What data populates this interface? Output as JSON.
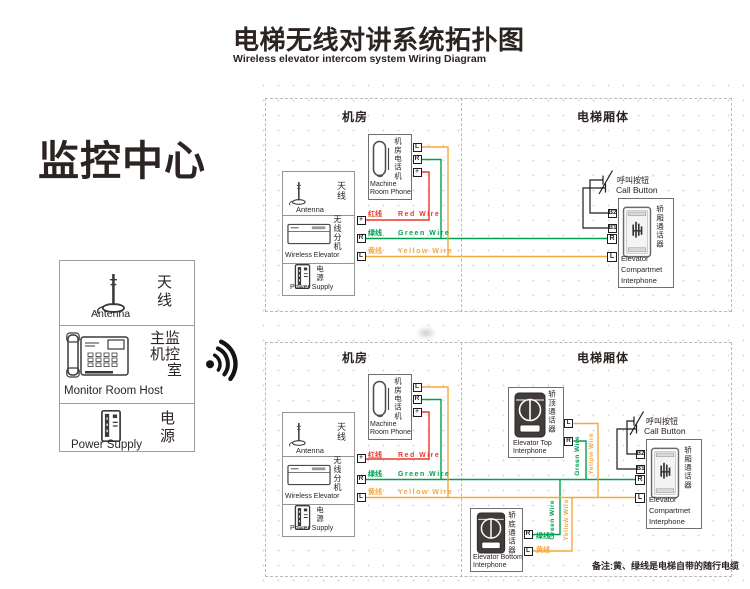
{
  "title": {
    "zh": "电梯无线对讲系统拓扑图",
    "en": "Wireless elevator intercom system Wiring Diagram"
  },
  "monitor": {
    "heading": "监控中心",
    "antenna_zh": "天线",
    "antenna_en": "Antenna",
    "host_line1": "主监",
    "host_line2": "机控",
    "host_line3": "室",
    "host_en": "Monitor Room Host",
    "power_zh": "电源",
    "power_en": "Power Supply"
  },
  "sections": {
    "machine_room": "机房",
    "elevator_car": "电梯厢体"
  },
  "machine_room": {
    "antenna_zh": "天线",
    "antenna_en": "Antenna",
    "wireless_zh": "无线分机",
    "wireless_en": "Wireless Elevator",
    "power_zh": "电源",
    "power_en": "Power Supply",
    "phone_zh": "机房电话机",
    "phone_en1": "Machine",
    "phone_en2": "Room Phone",
    "term_plus": "+",
    "term_r": "R",
    "term_l": "L",
    "wire_red_zh": "红线",
    "wire_red_en": "Red Wire",
    "wire_green_zh": "绿线",
    "wire_green_en": "Green Wire",
    "wire_yellow_zh": "黄线",
    "wire_yellow_en": "Yellow Wire"
  },
  "elevator": {
    "call_zh": "呼叫按钮",
    "call_en": "Call Button",
    "term_b2": "B2",
    "term_b1": "B1",
    "term_r": "R",
    "term_l": "L",
    "compartment_zh": "轿厢通话器",
    "compartment_en1": "Elevator",
    "compartment_en2": "Compartmet",
    "compartment_en3": "Interphone",
    "top_zh": "轿顶通话器",
    "top_en1": "Elevator Top",
    "top_en2": "Interphone",
    "bottom_zh": "轿底通话器",
    "bottom_en1": "Elevator Bottom",
    "bottom_en2": "Interphone",
    "green_short": "绿线",
    "yellow_short": "黄线",
    "green_vert": "Green Wire",
    "yellow_vert": "Yellow Wire"
  },
  "note": "备注:黄、绿线是电梯自带的随行电缆",
  "colors": {
    "red": "#e83828",
    "green": "#00a051",
    "yellow": "#f6a93b",
    "ink": "#2b2422"
  }
}
